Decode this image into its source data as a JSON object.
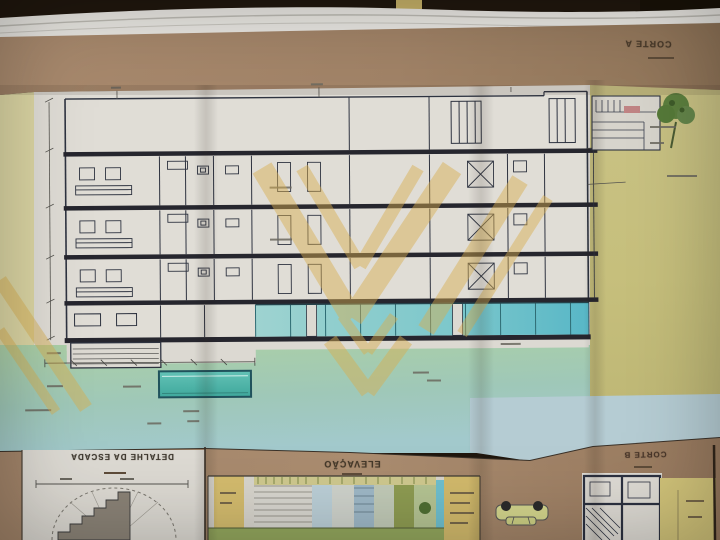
{
  "photo": {
    "subject": "architectural blueprint sheet photographed upside-down on a dark table",
    "drawings": [
      "building cross section",
      "stair detail",
      "elevation",
      "section B plan fragment"
    ]
  },
  "titles": {
    "corte_a": "CORTE A",
    "detalhe_escada": "DETALHE DA ESCADA",
    "elevacao": "ELEVAÇÃO",
    "corte_b": "CORTE B"
  },
  "colors": {
    "table_brown": "#20170e",
    "sheet_margin_tan": "#a5876b",
    "sheet_white": "#e0ddd6",
    "margin_cream": "#dcd6a4",
    "olive_panel": "#c7c07e",
    "ground_green": "#abcfa6",
    "ground_teal": "#9cc6bb",
    "sky_blue": "#b5ccd3",
    "glazing_cyan": "#7ec9cd",
    "pool_teal": "#4fb5a9",
    "watermark_gold": "#d9ae4f",
    "ink": "#2e3340"
  }
}
